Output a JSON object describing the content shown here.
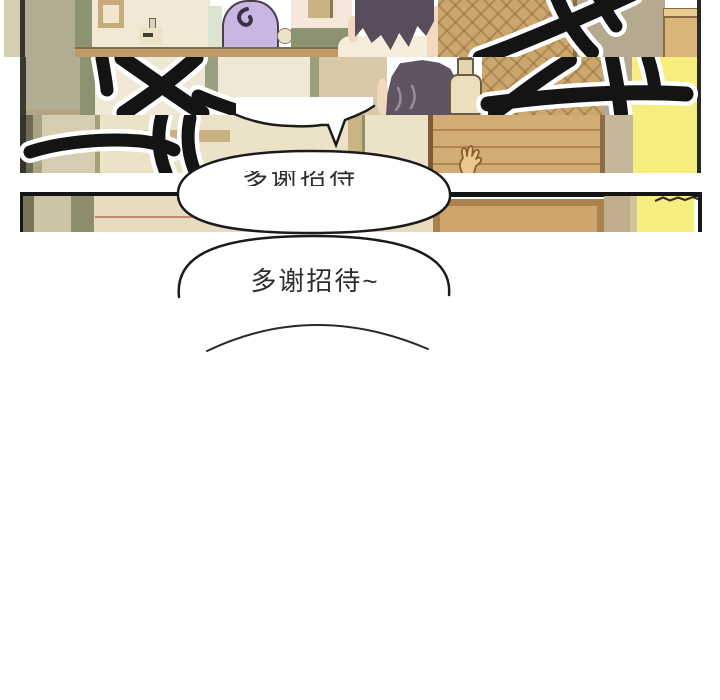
{
  "page": {
    "kind": "webtoon comic page",
    "bubbles": {
      "partial_text": "多谢招待",
      "main_text": "多谢招待~"
    },
    "palette": {
      "background": "#ffffff",
      "wall_olive": "#b2ad92",
      "wall_cream": "#e9dfc6",
      "window_frame_green": "#8c9372",
      "window_pane": "#f1e9d6",
      "purple_object": "#c9b6e2",
      "hair": "#574d5c",
      "skin": "#f2d8bd",
      "shirt": "#f6ecdb",
      "lattice_wood": "#cba76e",
      "door_wood": "#d3ac73",
      "door_frame": "#ab8150",
      "yellow_wall": "#f6ee7e",
      "bottle": "#ece0bc",
      "sfx_ink": "#141414",
      "bubble_fill": "#ffffff",
      "bubble_outline": "#1b1b1b",
      "panel_border": "#151515",
      "accent_line_red": "#c08a72"
    }
  }
}
